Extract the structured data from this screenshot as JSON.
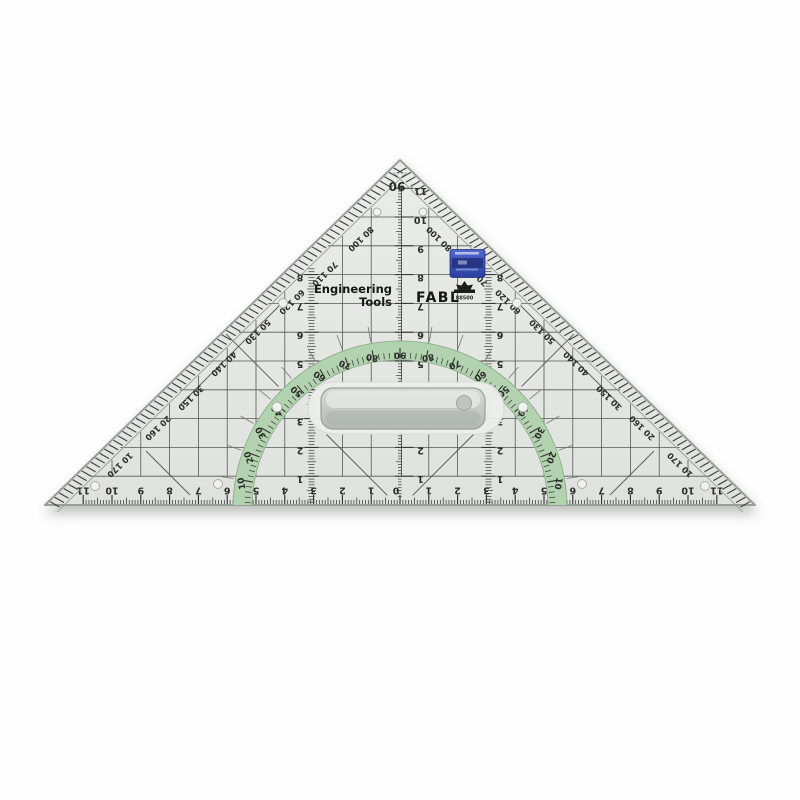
{
  "branding": {
    "line1": "Engineering",
    "line2": "Tools",
    "maker": "FABL",
    "model": "88500"
  },
  "icons": {
    "logo": "pagoda-emblem-icon",
    "sticker": "blue-label-sticker"
  },
  "markings": {
    "apex_angle": "90"
  },
  "colors": {
    "background": "#ffffff",
    "plastic": "#e4e7e3",
    "plastic_edge": "#98a09b",
    "ink": "#2b2b2b",
    "grid": "#575757",
    "protractor_green": "#b3d2af",
    "protractor_edge": "#86a884",
    "sticker_blue": "#3b53c2",
    "handle_gray": "#c3c9c5"
  },
  "scales": {
    "bottom_ruler": {
      "unit_cm_max": 11,
      "zero_at_center": true
    },
    "center_ruler": {
      "unit_cm_max": 11
    },
    "side_rulers": {
      "unit_cm_max": 8
    },
    "protractor": {
      "min_deg": 10,
      "max_deg": 170,
      "step_deg": 10,
      "top_value": 90,
      "symmetric": true
    },
    "edge_angle_pairs": [
      [
        "10",
        "170"
      ],
      [
        "20",
        "160"
      ],
      [
        "30",
        "150"
      ],
      [
        "40",
        "140"
      ],
      [
        "50",
        "130"
      ],
      [
        "60",
        "120"
      ],
      [
        "70",
        "110"
      ],
      [
        "80",
        "100"
      ]
    ]
  }
}
